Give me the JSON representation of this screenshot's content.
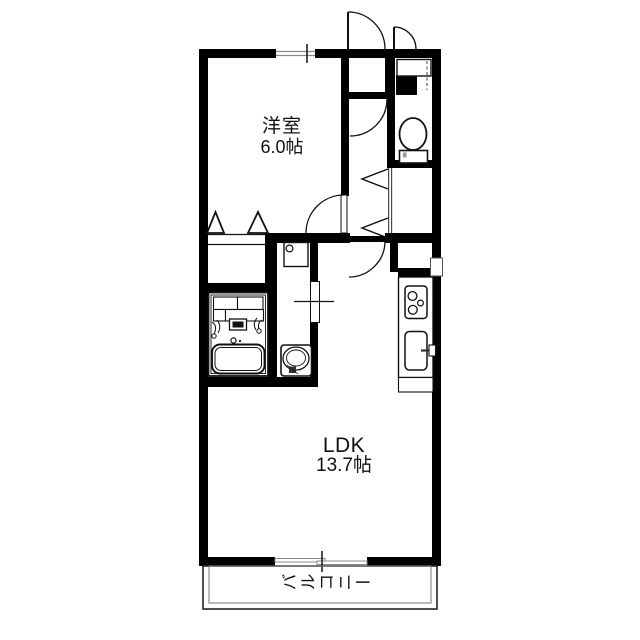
{
  "plan_type": "apartment-floor-plan",
  "rooms": {
    "western_room": {
      "label": "洋室",
      "size": "6.0帖"
    },
    "ldk": {
      "label": "LDK",
      "size": "13.7帖"
    },
    "balcony": {
      "label": "バルコニー"
    }
  },
  "fixtures": [
    {
      "name": "entrance-door"
    },
    {
      "name": "storage-door"
    },
    {
      "name": "shoe-cabinet"
    },
    {
      "name": "toilet"
    },
    {
      "name": "hall-closet-bifold"
    },
    {
      "name": "bedroom-closet-bifold"
    },
    {
      "name": "unit-bath"
    },
    {
      "name": "washing-machine-pan"
    },
    {
      "name": "washbasin"
    },
    {
      "name": "kitchen-stove"
    },
    {
      "name": "kitchen-sink"
    },
    {
      "name": "sliding-window-top"
    },
    {
      "name": "balcony-sliding-window"
    },
    {
      "name": "balcony-railing"
    }
  ],
  "colors": {
    "wall": "#000000",
    "line": "#111111",
    "window_line": "#8a8a8a",
    "bg": "#ffffff"
  }
}
